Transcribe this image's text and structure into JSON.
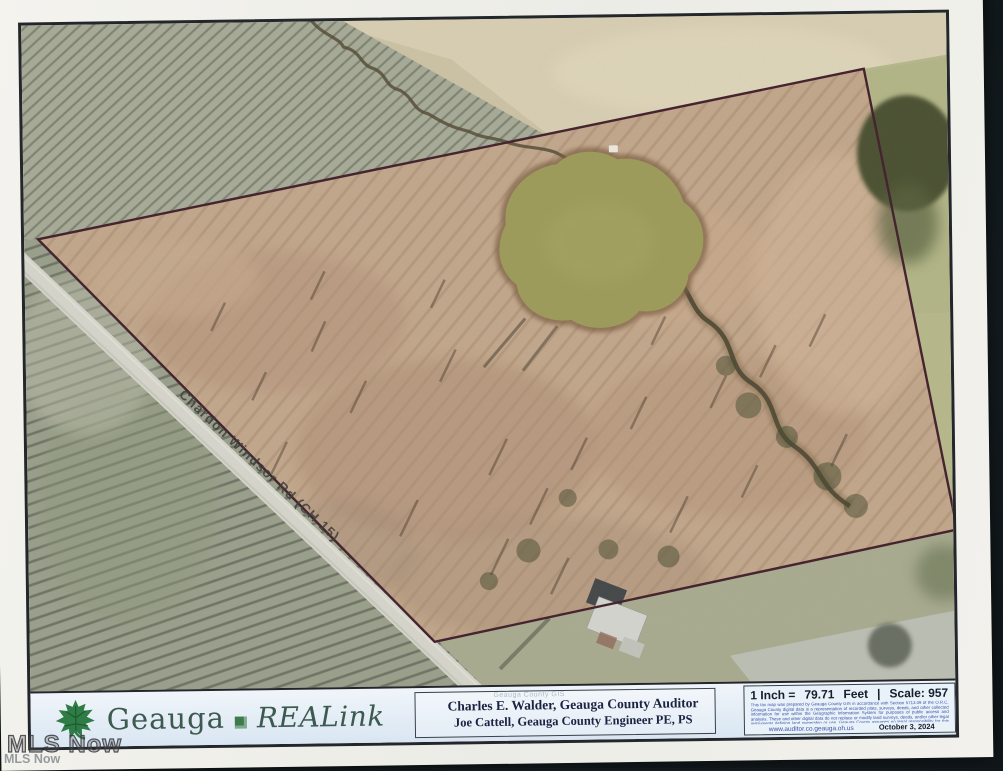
{
  "watermarks": {
    "large": "MLS Now",
    "small": "MLS Now"
  },
  "map": {
    "road_label": "Chardon Windsor Rd (CH 15)",
    "colors": {
      "parcel_boundary": "#43212d",
      "pond": "#9d9c5b",
      "road": "#d6d6cc",
      "woods": "#a7ab97",
      "parcel_field": "#c2a78c",
      "paper": "#f2f1ec",
      "footer_background": "#e2ebf4"
    }
  },
  "footer": {
    "brand": {
      "county": "Geauga",
      "product": "REALink"
    },
    "ghost_text": "Geauga County GIS",
    "officials": {
      "line1": "Charles E. Walder, Geauga County Auditor",
      "line2": "Joe Cattell, Geauga County Engineer PE, PS"
    },
    "scale": {
      "prefix": "1 Inch =",
      "value": "79.71",
      "unit": "Feet",
      "separator": "|",
      "scale_label": "Scale: 957"
    },
    "disclaimer": "This tax map was prepared by Geauga County GIS in accordance with Section 5713.09 of the O.R.C. Geauga County digital data is a representation of recorded plats, surveys, deeds, and other collected information for use within the Geographic Information System for purposes of public access and analysis. These and other digital data do not replace or modify land surveys, deeds, and/or other legal instruments defining land ownership or use. Geauga County assumes no legal responsibility for this information.",
    "url": "www.auditor.co.geauga.oh.us",
    "date": "October 3, 2024"
  }
}
